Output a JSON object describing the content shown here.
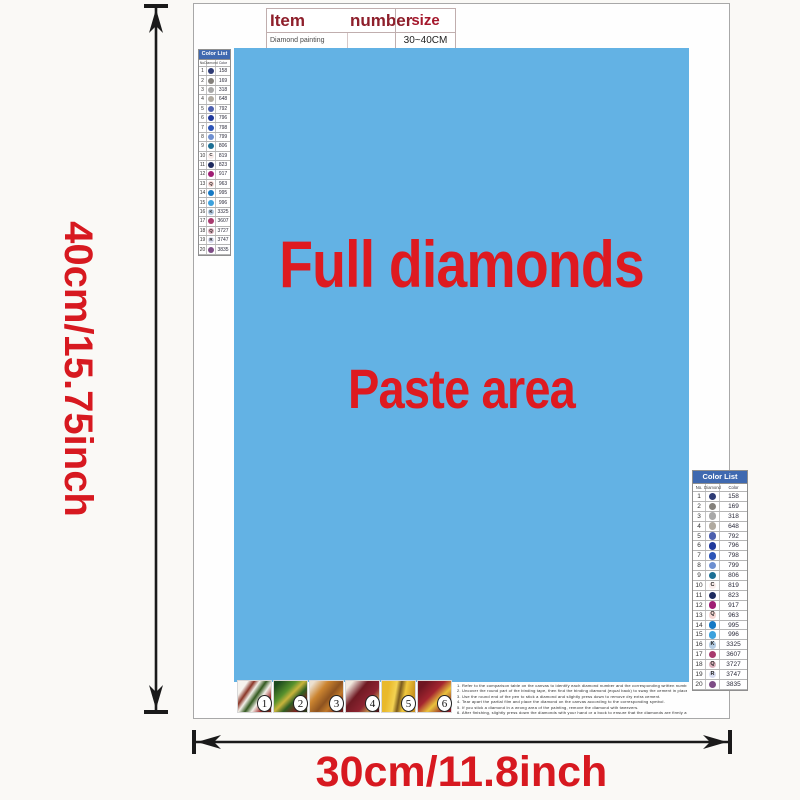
{
  "colors": {
    "paste_blue": "#63b2e4",
    "accent_red": "#de1a20",
    "list_header_blue": "#3f69b0"
  },
  "item_table": {
    "header": {
      "item": "Item",
      "number": "number",
      "size": "size"
    },
    "row": {
      "name": "Diamond painting",
      "number": "",
      "size": "30~40CM"
    }
  },
  "paste_area": {
    "line1": "Full diamonds",
    "line2": "Paste area"
  },
  "dimensions": {
    "height_label": "40cm/15.75inch",
    "width_label": "30cm/11.8inch"
  },
  "color_list": {
    "title": "Color List",
    "columns": [
      "No.",
      "Diamond",
      "Color"
    ],
    "rows": [
      {
        "no": "1",
        "code": "158",
        "dot": "#2e3b74",
        "letter": ""
      },
      {
        "no": "2",
        "code": "169",
        "dot": "#84817b",
        "letter": ""
      },
      {
        "no": "3",
        "code": "318",
        "dot": "#a8a8a8",
        "letter": ""
      },
      {
        "no": "4",
        "code": "648",
        "dot": "#b0aaa0",
        "letter": ""
      },
      {
        "no": "5",
        "code": "792",
        "dot": "#4c5fae",
        "letter": ""
      },
      {
        "no": "6",
        "code": "796",
        "dot": "#20399c",
        "letter": ""
      },
      {
        "no": "7",
        "code": "798",
        "dot": "#2d55b8",
        "letter": ""
      },
      {
        "no": "8",
        "code": "799",
        "dot": "#6e8fd0",
        "letter": ""
      },
      {
        "no": "9",
        "code": "806",
        "dot": "#1c6f94",
        "letter": ""
      },
      {
        "no": "10",
        "code": "819",
        "dot": "#f9ecea",
        "letter": "C"
      },
      {
        "no": "11",
        "code": "823",
        "dot": "#1d2a5e",
        "letter": ""
      },
      {
        "no": "12",
        "code": "917",
        "dot": "#a01e74",
        "letter": ""
      },
      {
        "no": "13",
        "code": "963",
        "dot": "#f6d5d2",
        "letter": "Q"
      },
      {
        "no": "14",
        "code": "995",
        "dot": "#1579c4",
        "letter": ""
      },
      {
        "no": "15",
        "code": "996",
        "dot": "#3da2dd",
        "letter": ""
      },
      {
        "no": "16",
        "code": "3325",
        "dot": "#b5cde4",
        "letter": "K"
      },
      {
        "no": "17",
        "code": "3607",
        "dot": "#a83a6e",
        "letter": ""
      },
      {
        "no": "18",
        "code": "3727",
        "dot": "#dcb0bc",
        "letter": "Q"
      },
      {
        "no": "19",
        "code": "3747",
        "dot": "#d8dcf0",
        "letter": "R"
      },
      {
        "no": "20",
        "code": "3835",
        "dot": "#7e4d86",
        "letter": ""
      }
    ]
  },
  "steps": [
    "1",
    "2",
    "3",
    "4",
    "5",
    "6"
  ],
  "instructions": [
    "1.  Refer  to  the  comparison  table  on  the  canvas  to  identify  each  diamond  number  and  the  corresponding  written  number  on  the  canvas.",
    "2.  Uncover  the  round  part  of  the  binding  tape,  then  find  the  binding  diamond  (equal  back)  to  sway  the  cement  in  place.",
    "3.  Use  the  round  end  of  the  pen  to  stick  a  diamond  and  slightly  press  down  to  remove  dry  extra  cement.",
    "4.  Tear  apart  the  partial  film  and  place  the  diamond  on  the  canvas  according  to  the  corresponding  symbol.",
    "5.  If  you  stick  a  diamond  in  a  wrong  area  of  the  painting,  remove  the  diamond  with  tweezers.",
    "6.  After  finishing,  slightly  press  down  the  diamonds  with  your  hand  or  a  book  to  ensure  that  the  diamonds  are  firmly  attached."
  ]
}
